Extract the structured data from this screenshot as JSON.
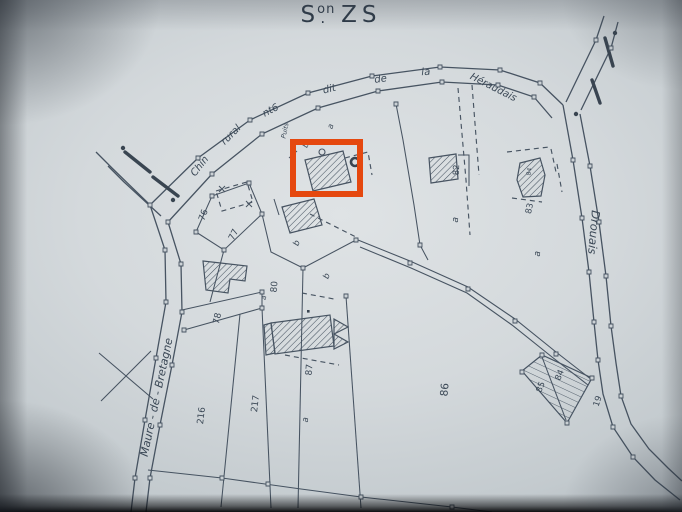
{
  "title": {
    "prefix": "S",
    "superscript": "on",
    "dot": ".",
    "name": "ZS"
  },
  "roads": {
    "chemin_rural": {
      "parts": [
        "Chin",
        "rural",
        "nt6",
        "dit",
        "de",
        "la",
        "Héraudais"
      ]
    },
    "maure_de_bretagne": {
      "label": "Maure - de - Bretagne"
    },
    "drouais": {
      "label": "Drouais"
    }
  },
  "labels": {
    "well": "Puits",
    "parcels": {
      "p76": "76",
      "p77": "77",
      "p78": "78",
      "p80": "80",
      "p82": "82",
      "p83": "83",
      "p84_building": "84",
      "p85": "85",
      "p84_talus": "84",
      "p86": "86",
      "p87": "87",
      "p216": "216",
      "p217": "217",
      "p19": "19"
    },
    "subdivisions": {
      "a_top": "a",
      "b_top": "b",
      "b_mid": "b",
      "b_low": "b",
      "a_small": "a",
      "a_mid": "a",
      "a_right": "a",
      "a_bottom": "a"
    }
  },
  "colors": {
    "paper": "#d4d9dc",
    "ink": "#3d4a59",
    "highlight": "#e5480f"
  }
}
